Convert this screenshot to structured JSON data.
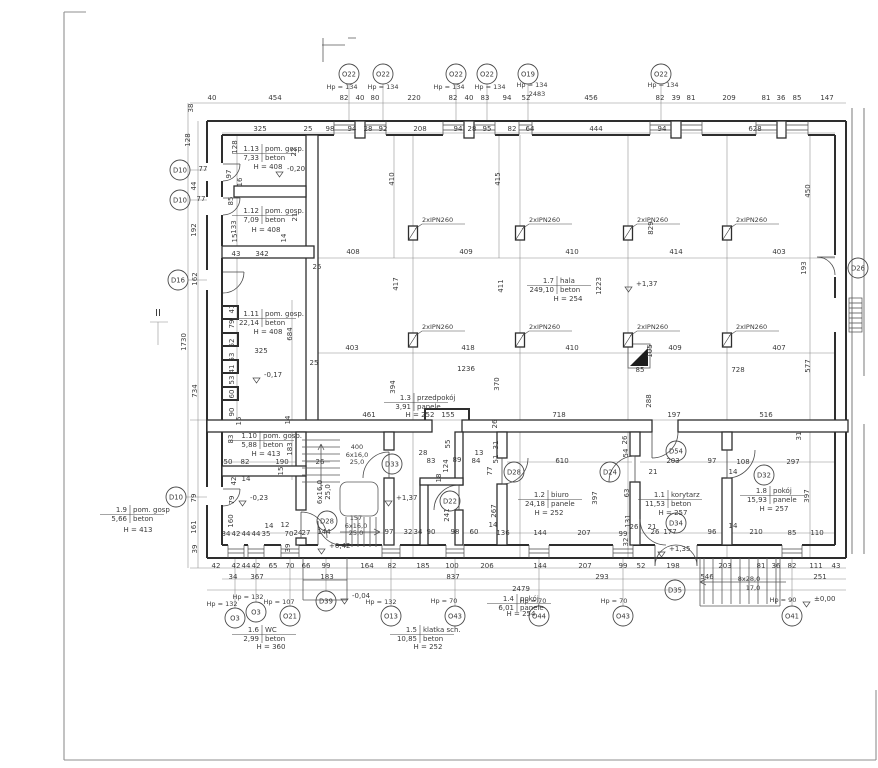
{
  "drawing_type": "architectural-floor-plan",
  "colors": {
    "ink": "#2e2e2e",
    "dim_line": "#8a8a8a",
    "text": "#3a3a3a",
    "paper": "#ffffff"
  },
  "columns": {
    "label": "2xIPN260",
    "positions": [
      [
        413,
        233
      ],
      [
        520,
        233
      ],
      [
        628,
        233
      ],
      [
        727,
        233
      ],
      [
        413,
        340
      ],
      [
        520,
        340
      ],
      [
        628,
        340
      ],
      [
        727,
        340
      ]
    ]
  },
  "rooms": [
    {
      "num": "1.13",
      "name": "pom. gosp.",
      "area": "7,33",
      "floor": "beton",
      "h": "H = 408",
      "x": 262,
      "y": 151,
      "hx": 268,
      "hy": 169
    },
    {
      "num": "1.12",
      "name": "pom. gosp.",
      "area": "7,09",
      "floor": "beton",
      "h": "H = 408",
      "x": 262,
      "y": 213,
      "hx": 266,
      "hy": 232
    },
    {
      "num": "1.11",
      "name": "pom. gosp.",
      "area": "22,14",
      "floor": "beton",
      "h": "H = 408",
      "x": 262,
      "y": 316,
      "hx": 268,
      "hy": 334
    },
    {
      "num": "1.10",
      "name": "pom. gosp.",
      "area": "5,88",
      "floor": "beton",
      "h": "H = 413",
      "x": 260,
      "y": 438,
      "hx": 266,
      "hy": 456
    },
    {
      "num": "1.9",
      "name": "pom. gosp",
      "area": "5,66",
      "floor": "beton",
      "h": "H = 413",
      "x": 130,
      "y": 512,
      "hx": 138,
      "hy": 532
    },
    {
      "num": "1.7",
      "name": "hala",
      "area": "249,10",
      "floor": "beton",
      "h": "H = 254",
      "x": 557,
      "y": 283,
      "hx": 568,
      "hy": 301
    },
    {
      "num": "1.3",
      "name": "przedpokój",
      "area": "3,91",
      "floor": "panele",
      "h": "H = 252",
      "x": 414,
      "y": 400,
      "hx": 420,
      "hy": 417
    },
    {
      "num": "1.2",
      "name": "biuro",
      "area": "24,18",
      "floor": "panele",
      "h": "H = 252",
      "x": 548,
      "y": 497,
      "hx": 549,
      "hy": 515
    },
    {
      "num": "1.1",
      "name": "korytarz",
      "area": "11,53",
      "floor": "beton",
      "h": "H = 257",
      "x": 668,
      "y": 497,
      "hx": 673,
      "hy": 515
    },
    {
      "num": "1.8",
      "name": "pokój",
      "area": "15,93",
      "floor": "panele",
      "h": "H = 257",
      "x": 770,
      "y": 493,
      "hx": 774,
      "hy": 511
    },
    {
      "num": "1.6",
      "name": "WC",
      "area": "2,99",
      "floor": "beton",
      "h": "H = 360",
      "x": 262,
      "y": 632,
      "hx": 271,
      "hy": 649
    },
    {
      "num": "1.5",
      "name": "klatka sch.",
      "area": "10,85",
      "floor": "beton",
      "h": "H = 252",
      "x": 420,
      "y": 632,
      "hx": 428,
      "hy": 649
    },
    {
      "num": "1.4",
      "name": "pokój",
      "area": "6,01",
      "floor": "panele",
      "h": "H = 254",
      "x": 517,
      "y": 601,
      "hx": 521,
      "hy": 616
    }
  ],
  "markers": [
    [
      349,
      74,
      "O22"
    ],
    [
      383,
      74,
      "O22"
    ],
    [
      456,
      74,
      "O22"
    ],
    [
      487,
      74,
      "O22"
    ],
    [
      528,
      74,
      "O19"
    ],
    [
      661,
      74,
      "O22"
    ],
    [
      180,
      170,
      "D10"
    ],
    [
      180,
      200,
      "D10"
    ],
    [
      178,
      280,
      "D16"
    ],
    [
      176,
      497,
      "D10"
    ],
    [
      858,
      268,
      "D26"
    ],
    [
      392,
      464,
      "D33"
    ],
    [
      450,
      501,
      "D22"
    ],
    [
      327,
      521,
      "D28"
    ],
    [
      514,
      472,
      "D28"
    ],
    [
      610,
      472,
      "D24"
    ],
    [
      676,
      451,
      "D54"
    ],
    [
      676,
      523,
      "D34"
    ],
    [
      764,
      475,
      "D32"
    ],
    [
      675,
      590,
      "D35"
    ],
    [
      326,
      601,
      "D39"
    ],
    [
      235,
      618,
      "O3"
    ],
    [
      256,
      612,
      "O3"
    ],
    [
      290,
      616,
      "O21"
    ],
    [
      391,
      616,
      "O13"
    ],
    [
      455,
      616,
      "O43"
    ],
    [
      539,
      616,
      "O44"
    ],
    [
      623,
      616,
      "O43"
    ],
    [
      792,
      616,
      "O41"
    ]
  ],
  "levels": [
    [
      287,
      171,
      "-0,20"
    ],
    [
      264,
      377,
      "-0,17"
    ],
    [
      250,
      500,
      "-0,23"
    ],
    [
      329,
      548,
      "+0,42"
    ],
    [
      636,
      286,
      "+1,37"
    ],
    [
      396,
      500,
      "+1,37"
    ],
    [
      669,
      551,
      "+1,35"
    ],
    [
      352,
      598,
      "-0,04"
    ],
    [
      814,
      601,
      "±0,00"
    ]
  ],
  "annotations": [
    [
      342,
      89,
      "Hp = 134"
    ],
    [
      383,
      89,
      "Hp = 134"
    ],
    [
      449,
      89,
      "Hp = 134"
    ],
    [
      490,
      89,
      "Hp = 134"
    ],
    [
      532,
      87,
      "Hp = 134"
    ],
    [
      537,
      96,
      "2483"
    ],
    [
      663,
      87,
      "Hp = 134"
    ],
    [
      222,
      606,
      "Hp = 132"
    ],
    [
      248,
      599,
      "Hp = 132"
    ],
    [
      279,
      604,
      "Hp = 107"
    ],
    [
      381,
      604,
      "Hp = 132"
    ],
    [
      444,
      603,
      "Hp = 70"
    ],
    [
      533,
      603,
      "Hp = 70"
    ],
    [
      614,
      603,
      "Hp = 70"
    ],
    [
      783,
      602,
      "Hp = 90"
    ],
    [
      357,
      449,
      "400"
    ],
    [
      357,
      457,
      "6x16,0"
    ],
    [
      357,
      464,
      "25,0"
    ],
    [
      356,
      520,
      "157"
    ],
    [
      356,
      528,
      "6x16,0"
    ],
    [
      356,
      535,
      "25,0"
    ],
    [
      749,
      581,
      "8x28,0"
    ],
    [
      753,
      590,
      "17,0"
    ],
    [
      158,
      316,
      "II",
      10
    ]
  ],
  "dims": {
    "h": [
      [
        212,
        100,
        "40"
      ],
      [
        275,
        100,
        "454"
      ],
      [
        344,
        100,
        "82"
      ],
      [
        360,
        100,
        "40"
      ],
      [
        375,
        100,
        "80"
      ],
      [
        414,
        100,
        "220"
      ],
      [
        453,
        100,
        "82"
      ],
      [
        469,
        100,
        "40"
      ],
      [
        485,
        100,
        "83"
      ],
      [
        507,
        100,
        "94"
      ],
      [
        526,
        100,
        "52"
      ],
      [
        591,
        100,
        "456"
      ],
      [
        660,
        100,
        "82"
      ],
      [
        676,
        100,
        "39"
      ],
      [
        691,
        100,
        "81"
      ],
      [
        729,
        100,
        "209"
      ],
      [
        766,
        100,
        "81"
      ],
      [
        781,
        100,
        "36"
      ],
      [
        797,
        100,
        "85"
      ],
      [
        827,
        100,
        "147"
      ],
      [
        260,
        131,
        "325"
      ],
      [
        308,
        131,
        "25"
      ],
      [
        330,
        131,
        "98"
      ],
      [
        352,
        131,
        "94"
      ],
      [
        368,
        131,
        "28"
      ],
      [
        383,
        131,
        "92"
      ],
      [
        420,
        131,
        "208"
      ],
      [
        458,
        131,
        "94"
      ],
      [
        472,
        131,
        "28"
      ],
      [
        487,
        131,
        "95"
      ],
      [
        512,
        131,
        "82"
      ],
      [
        530,
        131,
        "64"
      ],
      [
        596,
        131,
        "444"
      ],
      [
        662,
        131,
        "94"
      ],
      [
        755,
        131,
        "628"
      ],
      [
        203,
        171,
        "77"
      ],
      [
        201,
        201,
        "77"
      ],
      [
        236,
        256,
        "43"
      ],
      [
        262,
        256,
        "342"
      ],
      [
        317,
        269,
        "25"
      ],
      [
        314,
        365,
        "25"
      ],
      [
        261,
        353,
        "325"
      ],
      [
        228,
        464,
        "50"
      ],
      [
        245,
        464,
        "82"
      ],
      [
        282,
        464,
        "190"
      ],
      [
        320,
        464,
        "26"
      ],
      [
        246,
        481,
        "14"
      ],
      [
        226,
        536,
        "34"
      ],
      [
        236,
        536,
        "42"
      ],
      [
        246,
        536,
        "44"
      ],
      [
        256,
        536,
        "44"
      ],
      [
        266,
        536,
        "35"
      ],
      [
        269,
        528,
        "14"
      ],
      [
        285,
        527,
        "12"
      ],
      [
        289,
        536,
        "70"
      ],
      [
        298,
        535,
        "24"
      ],
      [
        306,
        535,
        "27"
      ],
      [
        324,
        534,
        "144"
      ],
      [
        466,
        371,
        "1236"
      ],
      [
        369,
        417,
        "461"
      ],
      [
        448,
        417,
        "155"
      ],
      [
        559,
        417,
        "718"
      ],
      [
        674,
        417,
        "197"
      ],
      [
        766,
        417,
        "516"
      ],
      [
        353,
        254,
        "408"
      ],
      [
        466,
        254,
        "409"
      ],
      [
        572,
        254,
        "410"
      ],
      [
        676,
        254,
        "414"
      ],
      [
        779,
        254,
        "403"
      ],
      [
        352,
        350,
        "403"
      ],
      [
        468,
        350,
        "418"
      ],
      [
        572,
        350,
        "410"
      ],
      [
        675,
        350,
        "409"
      ],
      [
        779,
        350,
        "407"
      ],
      [
        640,
        372,
        "85"
      ],
      [
        738,
        372,
        "728"
      ],
      [
        423,
        455,
        "28"
      ],
      [
        431,
        463,
        "83"
      ],
      [
        457,
        462,
        "89"
      ],
      [
        476,
        463,
        "84"
      ],
      [
        479,
        455,
        "13"
      ],
      [
        562,
        463,
        "610"
      ],
      [
        673,
        463,
        "203"
      ],
      [
        712,
        463,
        "97"
      ],
      [
        743,
        464,
        "108"
      ],
      [
        793,
        464,
        "297"
      ],
      [
        653,
        474,
        "21"
      ],
      [
        733,
        474,
        "14"
      ],
      [
        389,
        534,
        "97"
      ],
      [
        408,
        534,
        "32"
      ],
      [
        418,
        534,
        "34"
      ],
      [
        431,
        534,
        "90"
      ],
      [
        455,
        534,
        "98"
      ],
      [
        474,
        534,
        "60"
      ],
      [
        503,
        535,
        "136"
      ],
      [
        540,
        535,
        "144"
      ],
      [
        584,
        535,
        "207"
      ],
      [
        623,
        536,
        "99"
      ],
      [
        493,
        527,
        "14"
      ],
      [
        634,
        529,
        "26"
      ],
      [
        652,
        529,
        "21"
      ],
      [
        655,
        534,
        "26"
      ],
      [
        670,
        534,
        "177"
      ],
      [
        712,
        534,
        "96"
      ],
      [
        733,
        528,
        "14"
      ],
      [
        756,
        534,
        "210"
      ],
      [
        792,
        535,
        "85"
      ],
      [
        817,
        535,
        "110"
      ],
      [
        216,
        568,
        "42"
      ],
      [
        236,
        568,
        "42"
      ],
      [
        246,
        568,
        "44"
      ],
      [
        256,
        568,
        "42"
      ],
      [
        273,
        568,
        "65"
      ],
      [
        290,
        568,
        "70"
      ],
      [
        306,
        568,
        "66"
      ],
      [
        326,
        568,
        "99"
      ],
      [
        367,
        568,
        "164"
      ],
      [
        392,
        568,
        "82"
      ],
      [
        423,
        568,
        "185"
      ],
      [
        452,
        568,
        "100"
      ],
      [
        487,
        568,
        "206"
      ],
      [
        540,
        568,
        "144"
      ],
      [
        585,
        568,
        "207"
      ],
      [
        623,
        568,
        "99"
      ],
      [
        641,
        568,
        "52"
      ],
      [
        673,
        568,
        "198"
      ],
      [
        725,
        568,
        "203"
      ],
      [
        761,
        568,
        "81"
      ],
      [
        776,
        568,
        "36"
      ],
      [
        792,
        568,
        "82"
      ],
      [
        816,
        568,
        "111"
      ],
      [
        836,
        568,
        "43"
      ],
      [
        233,
        579,
        "34"
      ],
      [
        257,
        579,
        "367"
      ],
      [
        327,
        579,
        "183"
      ],
      [
        453,
        579,
        "837"
      ],
      [
        602,
        579,
        "293"
      ],
      [
        707,
        579,
        "546"
      ],
      [
        820,
        579,
        "251"
      ],
      [
        521,
        591,
        "2479"
      ]
    ],
    "v": [
      [
        193,
        108,
        "38"
      ],
      [
        190,
        140,
        "128"
      ],
      [
        237,
        147,
        "128"
      ],
      [
        231,
        174,
        "97"
      ],
      [
        196,
        186,
        "44"
      ],
      [
        196,
        230,
        "192"
      ],
      [
        197,
        279,
        "162"
      ],
      [
        186,
        342,
        "1730"
      ],
      [
        197,
        391,
        "734"
      ],
      [
        242,
        182,
        "16"
      ],
      [
        233,
        201,
        "85"
      ],
      [
        236,
        227,
        "133"
      ],
      [
        296,
        152,
        "22"
      ],
      [
        297,
        217,
        "21"
      ],
      [
        237,
        238,
        "15"
      ],
      [
        286,
        238,
        "14"
      ],
      [
        234,
        309,
        "41"
      ],
      [
        234,
        324,
        "79"
      ],
      [
        234,
        343,
        "62"
      ],
      [
        234,
        357,
        "53"
      ],
      [
        234,
        369,
        "41"
      ],
      [
        234,
        380,
        "53"
      ],
      [
        234,
        394,
        "60"
      ],
      [
        234,
        412,
        "90"
      ],
      [
        241,
        421,
        "15"
      ],
      [
        290,
        420,
        "14"
      ],
      [
        292,
        334,
        "684"
      ],
      [
        233,
        439,
        "83"
      ],
      [
        292,
        449,
        "183"
      ],
      [
        283,
        471,
        "15"
      ],
      [
        236,
        481,
        "42"
      ],
      [
        196,
        498,
        "79"
      ],
      [
        234,
        500,
        "79"
      ],
      [
        233,
        521,
        "160"
      ],
      [
        196,
        527,
        "161"
      ],
      [
        197,
        549,
        "39"
      ],
      [
        290,
        548,
        "39"
      ],
      [
        395,
        387,
        "394"
      ],
      [
        499,
        384,
        "370"
      ],
      [
        497,
        424,
        "26"
      ],
      [
        651,
        401,
        "288"
      ],
      [
        801,
        436,
        "31"
      ],
      [
        394,
        179,
        "410"
      ],
      [
        500,
        179,
        "415"
      ],
      [
        398,
        284,
        "417"
      ],
      [
        503,
        286,
        "411"
      ],
      [
        601,
        286,
        "1223"
      ],
      [
        653,
        228,
        "829"
      ],
      [
        810,
        191,
        "450"
      ],
      [
        806,
        268,
        "193"
      ],
      [
        652,
        351,
        "105"
      ],
      [
        810,
        366,
        "577"
      ],
      [
        448,
        466,
        "124"
      ],
      [
        450,
        444,
        "55"
      ],
      [
        498,
        459,
        "51"
      ],
      [
        498,
        445,
        "31"
      ],
      [
        441,
        478,
        "18"
      ],
      [
        492,
        471,
        "77"
      ],
      [
        627,
        440,
        "26"
      ],
      [
        628,
        453,
        "54"
      ],
      [
        629,
        493,
        "63"
      ],
      [
        597,
        498,
        "397"
      ],
      [
        496,
        511,
        "267"
      ],
      [
        449,
        515,
        "241"
      ],
      [
        809,
        496,
        "397"
      ],
      [
        628,
        542,
        "32"
      ],
      [
        630,
        521,
        "131"
      ],
      [
        322,
        492,
        "6x16,0"
      ],
      [
        330,
        492,
        "25,0"
      ]
    ]
  }
}
